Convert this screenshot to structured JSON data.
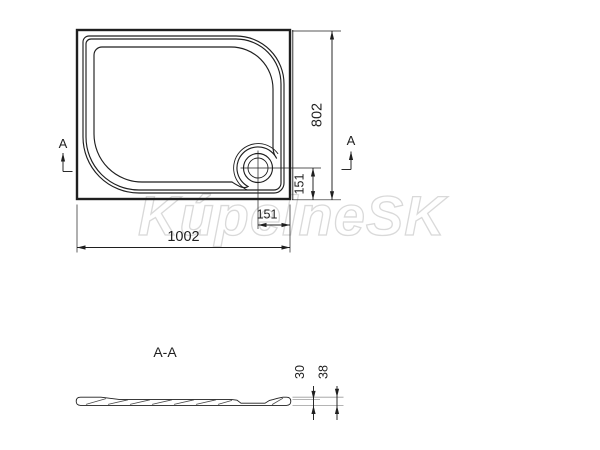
{
  "watermark": "KúpelneSK",
  "top_view": {
    "dim_width": "1002",
    "dim_height": "802",
    "dim_drain_from_bottom": "151",
    "dim_drain_from_right": "151",
    "section_marker_left": "A",
    "section_marker_right": "A"
  },
  "section_view": {
    "title": "A-A",
    "dim_inner_height": "30",
    "dim_total_height": "38"
  },
  "colors": {
    "ink": "#1f1f1f",
    "reference_line": "#9c9c9c",
    "watermark_outline": "#c9c9c9",
    "background": "#ffffff"
  }
}
